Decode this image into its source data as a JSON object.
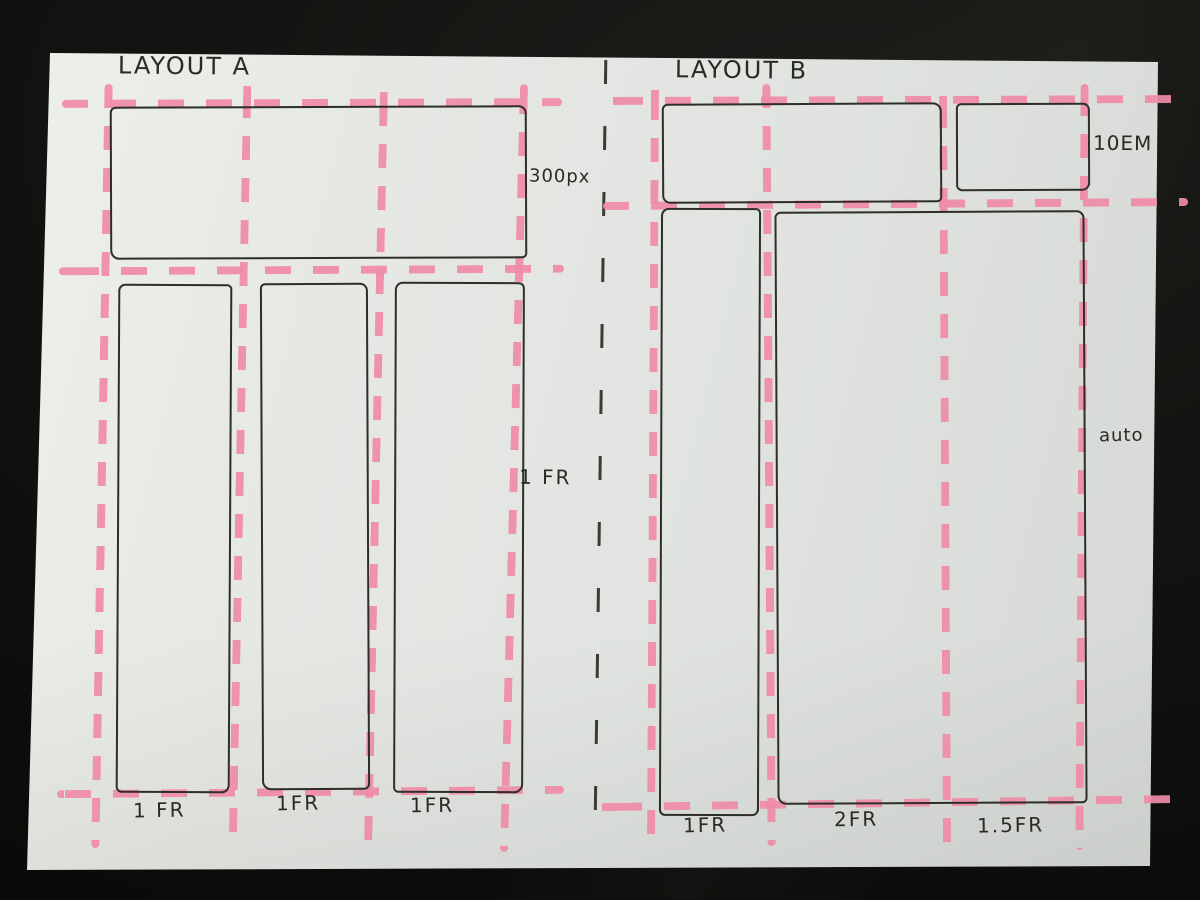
{
  "scene": {
    "background_color": "#131311",
    "paper_color": "#e4e6e3",
    "pink_color": "#f08ba7",
    "ink_color": "#2e2e29"
  },
  "layout_a": {
    "title": "LAYOUT A",
    "row_labels": {
      "header": "300px",
      "content": "1 FR"
    },
    "column_labels": [
      "1 FR",
      "1FR",
      "1FR"
    ]
  },
  "layout_b": {
    "title": "LAYOUT B",
    "row_labels": {
      "header": "10EM",
      "content": "auto"
    },
    "column_labels": [
      "1FR",
      "2FR",
      "1.5FR"
    ]
  }
}
